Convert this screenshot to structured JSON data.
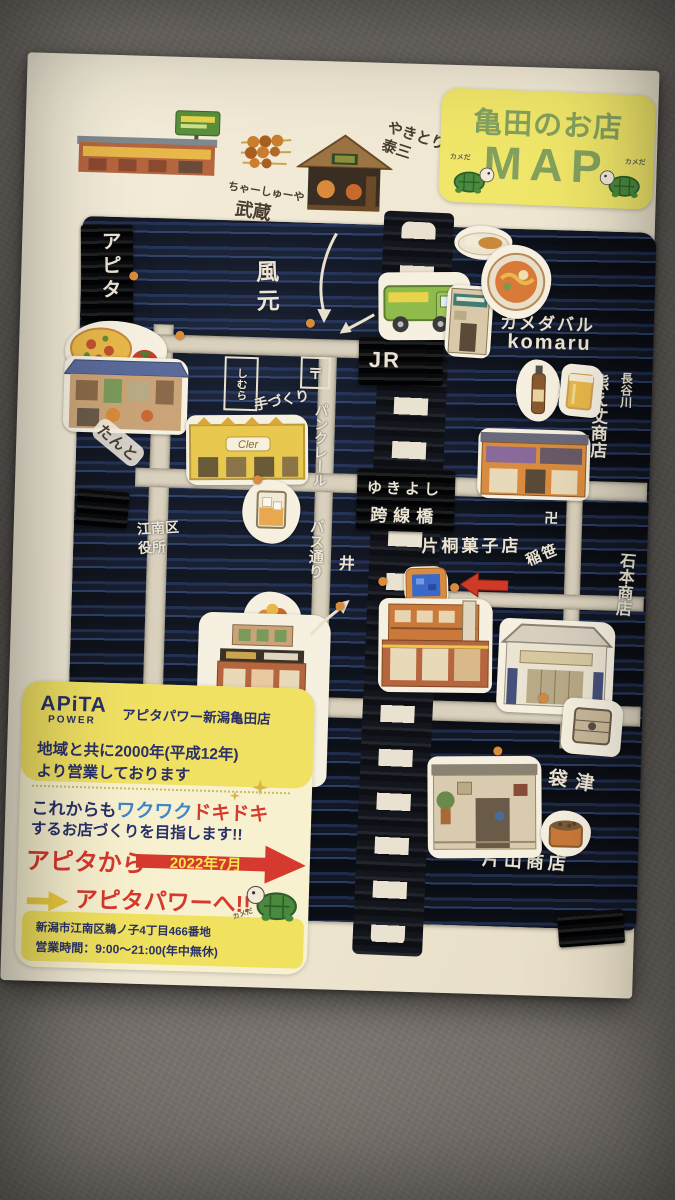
{
  "banner": {
    "title": "亀田のお店",
    "map": "MAP",
    "turtle_caption": "カメだ"
  },
  "top_area": {
    "yakitori_taizo": "やきとり 泰三",
    "musashi_kana": "ちゃーしゅーや",
    "musashi": "武蔵"
  },
  "map_labels": {
    "apita": "アピタ",
    "kazamoto": "風元",
    "kamedabaru": "カメダバル",
    "komaru": "komaru",
    "jr": "JR",
    "post_mark": "〒",
    "shimura": "しむら",
    "tezukuri": "手づくり",
    "pan_cler": "パンクレール",
    "cler_sign": "Cler",
    "hasegawa": "長谷川",
    "kumaejo": "熊え丈商店",
    "tanto": "たんと",
    "kuyakusho": "江南区役所",
    "bus_dori": "バス通り",
    "yukiyoshi": "ゆきよし",
    "kosenkyo": "跨線橋",
    "katagiri": "片桐菓子店",
    "inasasa": "稲笹",
    "ishimoto": "石本商店",
    "manpei": "万平菓子舗",
    "fukurozu": "袋津",
    "katayama": "片山商店",
    "well_mark": "井",
    "manji_mark": "卍"
  },
  "info_panel": {
    "logo_top": "APiTA",
    "logo_bottom": "POWER",
    "store_name": "アピタパワー新潟亀田店",
    "tagline_line1": "地域と共に2000年(平成12年)",
    "tagline_line2": "より営業しております",
    "promo_prefix": "これからも",
    "promo_waku": "ワクワク",
    "promo_doki": "ドキドキ",
    "promo_line2": "するお店づくりを目指します!!",
    "from_text": "アピタから",
    "date_text": "2022年7月",
    "to_text": "アピタパワーへ!!",
    "address": "新潟市江南区鵜ノ子4丁目466番地",
    "hours": "営業時間：9:00～21:00(年中無休)",
    "turtle_caption": "カメだ"
  },
  "decor": {
    "sparkle": "✦"
  }
}
